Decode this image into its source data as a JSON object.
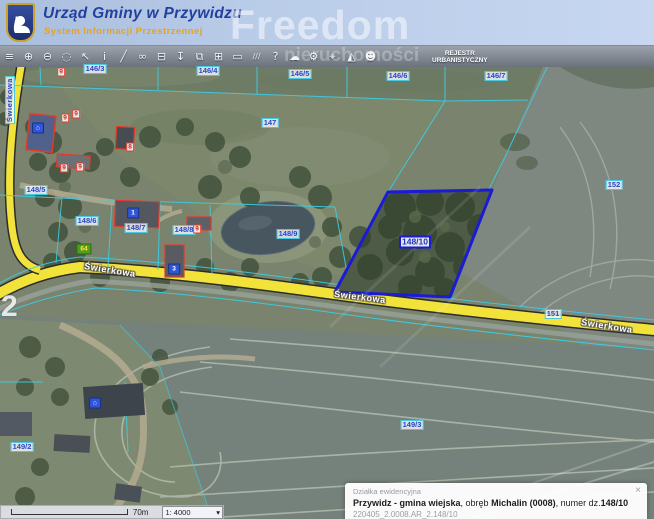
{
  "header": {
    "title": "Urząd Gminy w Przywidzu",
    "subtitle": "System Informacji Przestrzennej"
  },
  "watermark": {
    "brand": "Freedom",
    "brand2": "nieruchomości",
    "photo_number": "2"
  },
  "toolbar": {
    "register_line1": "REJESTR",
    "register_line2": "URBANISTYCZNY",
    "items": [
      {
        "name": "layers"
      },
      {
        "name": "zoom-in"
      },
      {
        "name": "zoom-out"
      },
      {
        "name": "select-shape"
      },
      {
        "name": "pointer"
      },
      {
        "name": "identify-info"
      },
      {
        "name": "draw-line"
      },
      {
        "name": "link"
      },
      {
        "name": "print"
      },
      {
        "name": "download-pin"
      },
      {
        "name": "copy-window"
      },
      {
        "name": "split-panels"
      },
      {
        "name": "comment-bubble"
      },
      {
        "name": "measure"
      },
      {
        "name": "help"
      },
      {
        "name": "cloud-upload"
      },
      {
        "name": "settings-gears"
      },
      {
        "name": "search-locate"
      },
      {
        "name": "terrain-3d"
      },
      {
        "name": "contact-person"
      }
    ]
  },
  "map": {
    "parcel_labels": [
      {
        "text": "146/3",
        "x": 95,
        "y": 69
      },
      {
        "text": "146/4",
        "x": 208,
        "y": 71
      },
      {
        "text": "146/5",
        "x": 300,
        "y": 74
      },
      {
        "text": "146/6",
        "x": 398,
        "y": 76
      },
      {
        "text": "146/7",
        "x": 496,
        "y": 76
      },
      {
        "text": "147",
        "x": 270,
        "y": 123
      },
      {
        "text": "148/5",
        "x": 36,
        "y": 190
      },
      {
        "text": "148/6",
        "x": 87,
        "y": 221
      },
      {
        "text": "148/7",
        "x": 136,
        "y": 228
      },
      {
        "text": "148/8",
        "x": 184,
        "y": 230
      },
      {
        "text": "148/9",
        "x": 288,
        "y": 234
      },
      {
        "text": "151",
        "x": 553,
        "y": 314
      },
      {
        "text": "152",
        "x": 614,
        "y": 185
      },
      {
        "text": "149/2",
        "x": 22,
        "y": 447
      },
      {
        "text": "149/3",
        "x": 412,
        "y": 425
      }
    ],
    "selected_parcel": {
      "text": "148/10",
      "x": 415,
      "y": 242
    },
    "street_labels": [
      {
        "text": "Świerkowa",
        "x": 110,
        "y": 270,
        "rot": 9
      },
      {
        "text": "Świerkowa",
        "x": 360,
        "y": 297,
        "rot": 7
      },
      {
        "text": "Świerkowa",
        "x": 607,
        "y": 326,
        "rot": 9
      },
      {
        "text": "Świerkowa",
        "x": 10,
        "y": 100,
        "rot": -90,
        "boxed": true
      }
    ],
    "address_markers": [
      {
        "kind": "house",
        "x": 38,
        "y": 128
      },
      {
        "text": "1",
        "x": 133,
        "y": 213
      },
      {
        "text": "3",
        "x": 174,
        "y": 269
      },
      {
        "kind": "house",
        "x": 95,
        "y": 403
      },
      {
        "text": "64",
        "x": 84,
        "y": 249,
        "green": true
      }
    ],
    "building_numbers": [
      {
        "text": "9",
        "x": 61,
        "y": 72
      },
      {
        "text": "9",
        "x": 65,
        "y": 118
      },
      {
        "text": "9",
        "x": 76,
        "y": 114
      },
      {
        "text": "8",
        "x": 130,
        "y": 147
      },
      {
        "text": "9",
        "x": 64,
        "y": 168
      },
      {
        "text": "9",
        "x": 80,
        "y": 167
      },
      {
        "text": "9",
        "x": 197,
        "y": 229
      }
    ]
  },
  "footer": {
    "scale_distance": "70m",
    "scale_ratio": "1: 4000",
    "dropdown_arrow": "▾"
  },
  "info_panel": {
    "title": "Działka ewidencyjna",
    "close": "×",
    "bold1": "Przywidz - gmina wiejska",
    "sep1": ", obręb ",
    "bold2": "Michalin (0008)",
    "sep2": ", numer dz.",
    "bold3": "148/10",
    "code": "220405_2.0008.AR_2.148/10"
  },
  "colors": {
    "road_yellow": "#f2e33b",
    "cadastral_cyan": "#3bcfe6",
    "selected_outline": "#1b1bd6",
    "header_title_blue": "#23409e",
    "subtitle_orange": "#e8a21d"
  }
}
